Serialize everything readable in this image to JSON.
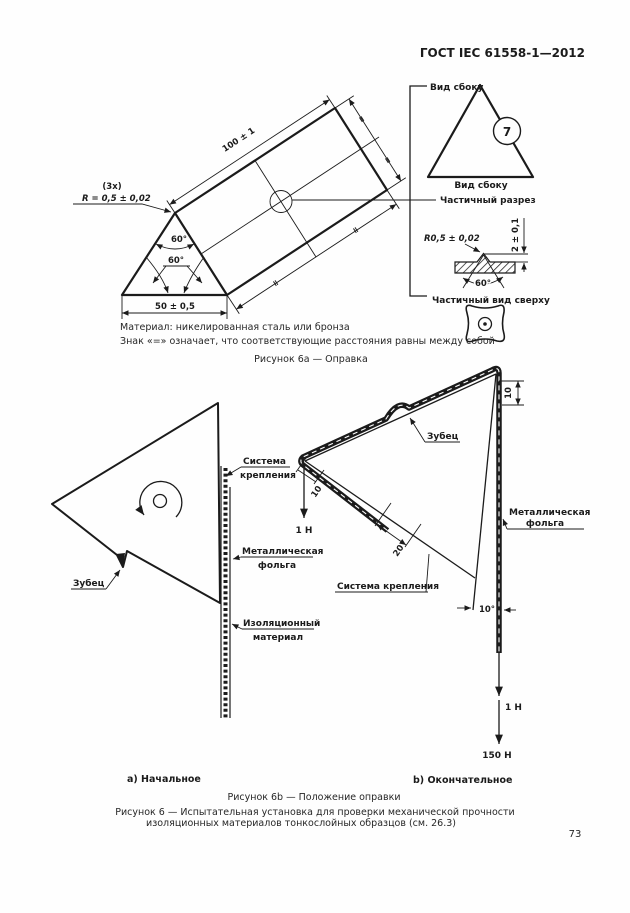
{
  "page": {
    "header": "ГОСТ IEC 61558-1—2012",
    "page_number": "73"
  },
  "figure6a": {
    "view_side_top": "Вид сбоку",
    "view_side_bottom": "Вид сбоку",
    "partial_section": "Частичный разрез",
    "partial_top_view": "Частичный вид сверху",
    "detail_marker": "7",
    "dim_length": "100 ± 1",
    "dim_base": "50 ± 0,5",
    "angle_apex": "60°",
    "angle_base": "60°",
    "radius_qty": "(3x)",
    "radius": "R = 0,5 ± 0,02",
    "equal_mark": "=",
    "section_radius": "R0,5 ± 0,02",
    "section_height": "2 ± 0,1",
    "section_angle": "60°",
    "note_material": "Материал: никелированная сталь или бронза",
    "note_equal": "Знак «=» означает, что соответствующие расстояния равны между собой",
    "caption": "Рисунок 6а — Оправка"
  },
  "figure6b": {
    "initial": {
      "tooth": "Зубец",
      "fastening1": "Система",
      "fastening2": "крепления",
      "foil1": "Металлическая",
      "foil2": "фольга",
      "insulation1": "Изоляционный",
      "insulation2": "материал",
      "caption": "а) Начальное"
    },
    "final": {
      "tooth": "Зубец",
      "fastening": "Система крепления",
      "foil1": "Металлическая",
      "foil2": "фольга",
      "dim_top": "10",
      "dim_vertex": "10",
      "dim_clamp": "20",
      "angle": "10°",
      "force_initial": "1 Н",
      "force_small": "1 Н",
      "force_large": "150 Н",
      "caption": "b) Окончательное"
    },
    "caption": "Рисунок 6b — Положение оправки"
  },
  "figure6": {
    "caption1": "Рисунок 6 — Испытательная установка для проверки механической прочности",
    "caption2": "изоляционных материалов тонкослойных образцов (см. 26.3)"
  }
}
